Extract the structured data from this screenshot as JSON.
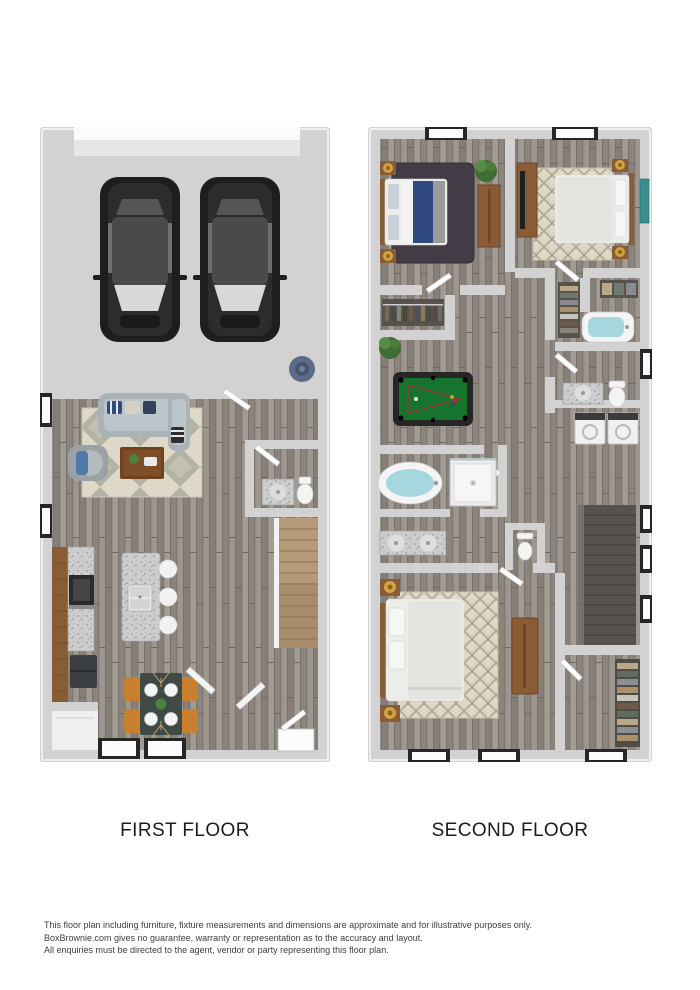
{
  "labels": {
    "first_floor": "FIRST FLOOR",
    "second_floor": "SECOND FLOOR"
  },
  "disclaimer": {
    "line1": "This floor plan including furniture, fixture measurements and dimensions are approximate and for illustrative purposes only.",
    "line2": "BoxBrownie.com gives no guarantee, warranty or representation as to the accuracy and layout.",
    "line3": "All enquiries must be directed to the agent, vendor or party representing this floor plan."
  },
  "plans": [
    {
      "id": "first-floor",
      "label": "FIRST FLOOR",
      "features": [
        "garage-two-cars",
        "water-heater",
        "living-room-sofa",
        "armchair",
        "coffee-table",
        "area-rug",
        "powder-room",
        "staircase",
        "kitchen-counter",
        "kitchen-island-with-stools",
        "dining-table-four-chairs",
        "windows",
        "entry-door"
      ]
    },
    {
      "id": "second-floor",
      "label": "SECOND FLOOR",
      "features": [
        "bedroom-left",
        "bedroom-right",
        "master-bedroom",
        "loft-pool-table",
        "hall-bathroom-tub",
        "washer-dryer",
        "master-bath-soaking-tub",
        "shower",
        "double-vanity",
        "toilet-rooms",
        "closets",
        "staircase",
        "windows"
      ]
    }
  ],
  "colors": {
    "background": "#ffffff",
    "wall": "#d2d2d2",
    "concrete_floor": "#d3d2d0",
    "wood_floor": "#948d86",
    "window_frame": "#262626",
    "window_glass": "#fbfbfb",
    "car_body": "#1e1e1e",
    "car_roof": "#4a4a4a",
    "car_glass": "#d8d8d8",
    "water_heater_blue": "#5a6c8b",
    "sofa_gray": "#bcc5c9",
    "accent_navy": "#2e4a80",
    "armchair_blue": "#4f79a8",
    "rug_cream": "#ddd8c8",
    "rug_dark_shag": "#423c46",
    "wood_furniture": "#8a5c36",
    "granite": "#cdcdcd",
    "appliance_dark": "#2b2b2b",
    "stool_white": "#f2f2f2",
    "dining_chair_orange": "#c8802f",
    "dining_table": "#3f4a45",
    "stair_wood_light": "#b49a77",
    "stair_wood_dark": "#56524d",
    "pool_felt_green": "#17742e",
    "pool_frame": "#262626",
    "bath_water_blue": "#a6d7de",
    "fixture_white": "#f4f4f4",
    "bed_linen": "#ececea",
    "lamp_gold": "#d2a245",
    "plant_green": "#4e8040",
    "art_teal": "#3b8e8e",
    "trellis_rug": "#ded8c2",
    "label_text": "#1c1c1c",
    "disclaimer_text": "#3d3d3d"
  }
}
